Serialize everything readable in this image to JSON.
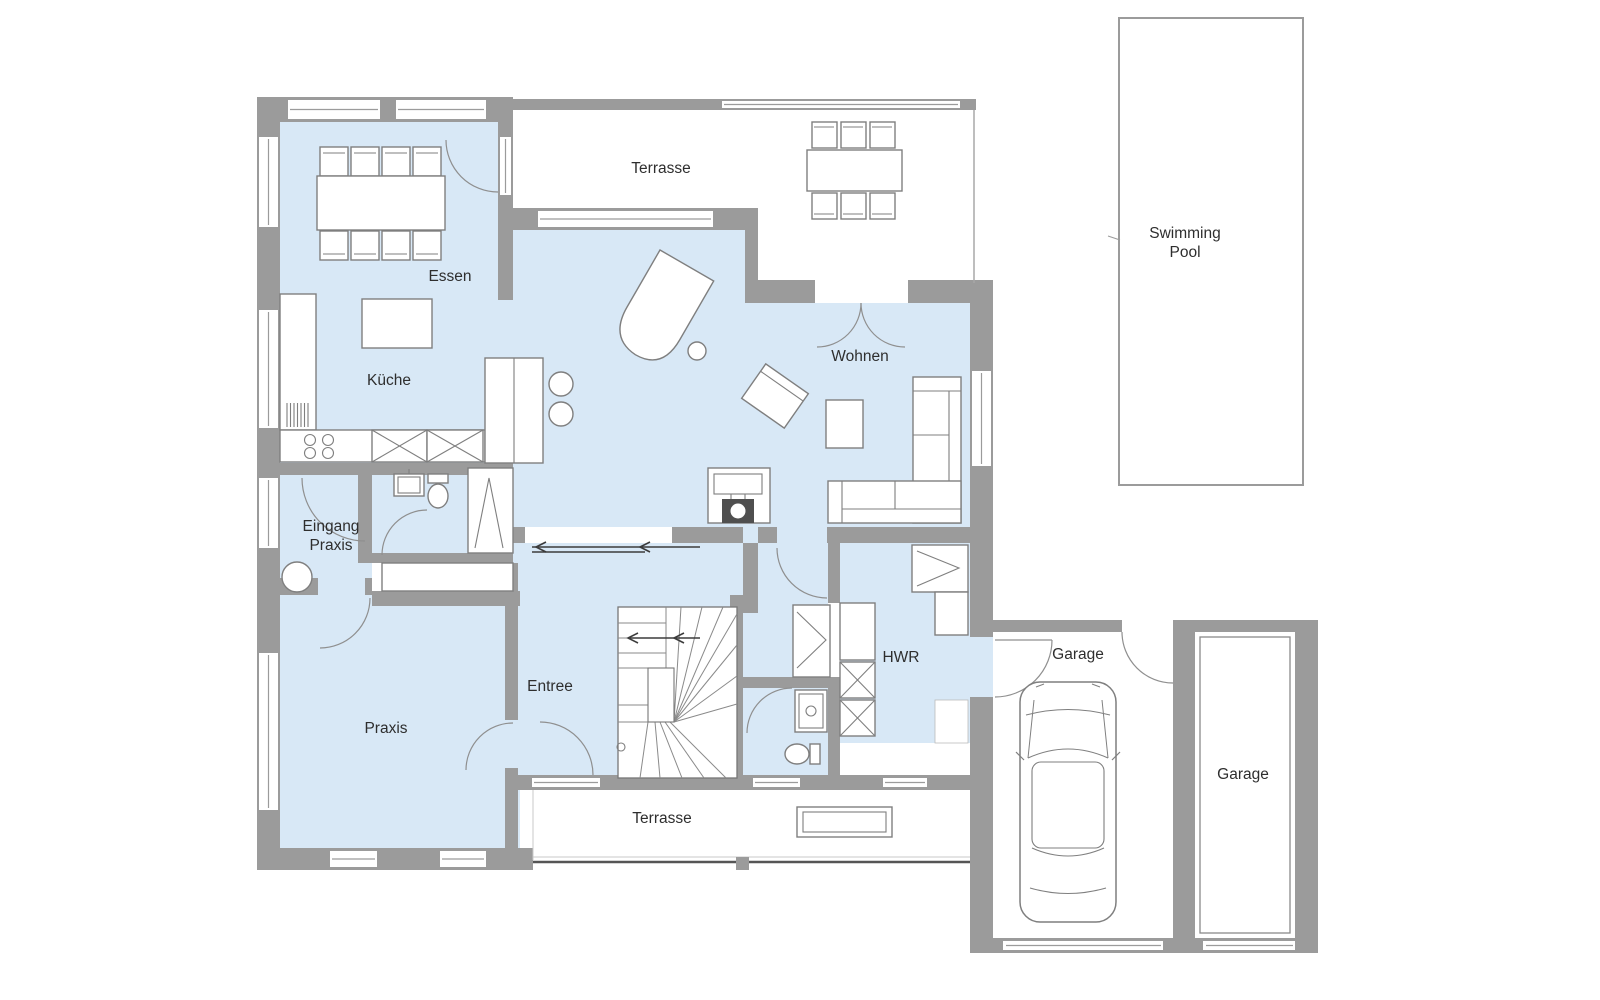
{
  "title": "Erdgeschoss Grundriss",
  "colors": {
    "wall": "#9b9b9b",
    "room_fill": "#d8e8f6",
    "furniture_line": "#7f7f7f",
    "stove_dark": "#4f4f4f",
    "text": "#2e2e2e"
  },
  "rooms": {
    "essen": {
      "label": "Essen"
    },
    "kueche": {
      "label": "Küche"
    },
    "wohnen": {
      "label": "Wohnen"
    },
    "eingang_praxis": {
      "label_line1": "Eingang",
      "label_line2": "Praxis"
    },
    "praxis": {
      "label": "Praxis"
    },
    "entree": {
      "label": "Entree"
    },
    "hwr": {
      "label": "HWR"
    }
  },
  "outdoor": {
    "terrasse_top": {
      "label": "Terrasse"
    },
    "terrasse_bottom": {
      "label": "Terrasse"
    },
    "pool": {
      "label_line1": "Swimming",
      "label_line2": "Pool"
    },
    "garage_left": {
      "label": "Garage"
    },
    "garage_right": {
      "label": "Garage"
    }
  }
}
